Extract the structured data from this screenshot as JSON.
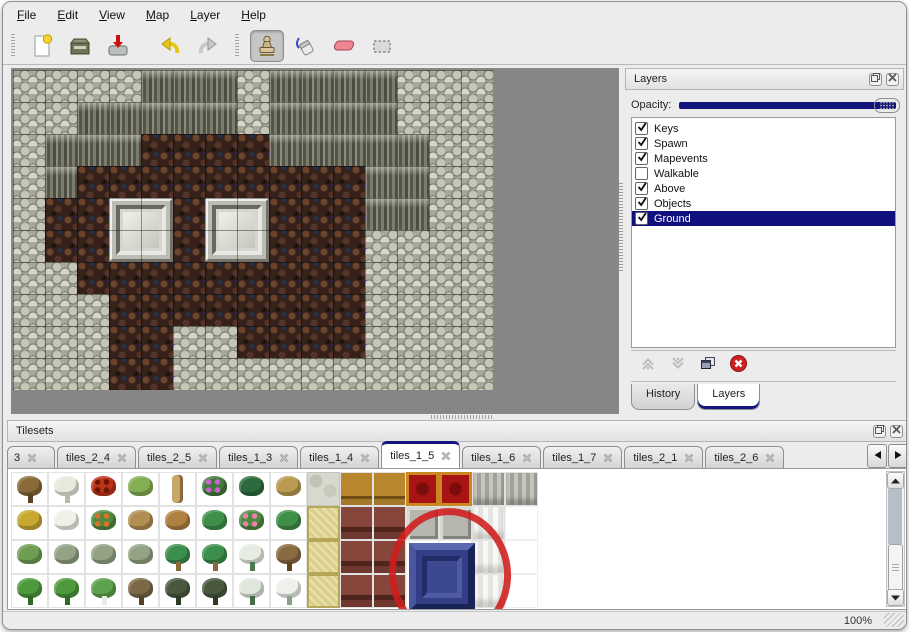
{
  "menu": {
    "items": [
      {
        "label": "File"
      },
      {
        "label": "Edit"
      },
      {
        "label": "View"
      },
      {
        "label": "Map"
      },
      {
        "label": "Layer"
      },
      {
        "label": "Help"
      }
    ]
  },
  "toolbar": {
    "buttons": [
      {
        "name": "new-map",
        "icon": "new",
        "active": false
      },
      {
        "name": "open-map",
        "icon": "open",
        "active": false
      },
      {
        "name": "save-map",
        "icon": "save",
        "active": false
      },
      {
        "name": "undo",
        "icon": "undo",
        "active": false
      },
      {
        "name": "redo",
        "icon": "redo",
        "active": false
      },
      {
        "name": "stamp-tool",
        "icon": "stamp",
        "active": true
      },
      {
        "name": "fill-tool",
        "icon": "fill",
        "active": false
      },
      {
        "name": "eraser-tool",
        "icon": "eraser",
        "active": false
      },
      {
        "name": "select-tool",
        "icon": "select",
        "active": false
      }
    ]
  },
  "map": {
    "legend": {
      "S": "light-scale-rock",
      "C": "dark-cliff-wall",
      "B": "brown-cave-floor"
    },
    "grid": [
      "SSSSCCCSCCCCSSS",
      "SSCCCCCSCCCCSSS",
      "SCCCBBBBCCCCCSS",
      "SCBBBBBBBBBCCSS",
      "SBBBBBBBBBBCCSS",
      "SBBBBBBBBBBSSSS",
      "SSBBBBBBBBBSSSS",
      "SSSBBBBBBBBSSSS",
      "SSSBBSSBBBBSSSS",
      "SSSBBSSSSSSSSSS"
    ],
    "doors": [
      {
        "col": 3,
        "row": 4
      },
      {
        "col": 6,
        "row": 4
      }
    ]
  },
  "layers_panel": {
    "title": "Layers",
    "opacity_label": "Opacity:",
    "opacity_value_percent": 100,
    "layers": [
      {
        "label": "Keys",
        "checked": true,
        "selected": false
      },
      {
        "label": "Spawn",
        "checked": true,
        "selected": false
      },
      {
        "label": "Mapevents",
        "checked": true,
        "selected": false
      },
      {
        "label": "Walkable",
        "checked": false,
        "selected": false
      },
      {
        "label": "Above",
        "checked": true,
        "selected": false
      },
      {
        "label": "Objects",
        "checked": true,
        "selected": false
      },
      {
        "label": "Ground",
        "checked": true,
        "selected": true
      }
    ],
    "tools": [
      {
        "name": "move-layer-up",
        "icon": "chevUp",
        "enabled": false
      },
      {
        "name": "move-layer-down",
        "icon": "chevDown",
        "enabled": false
      },
      {
        "name": "duplicate-layer",
        "icon": "copy",
        "enabled": true
      },
      {
        "name": "delete-layer",
        "icon": "delete",
        "enabled": true
      }
    ],
    "tabs": [
      {
        "label": "History",
        "active": false
      },
      {
        "label": "Layers",
        "active": true
      }
    ]
  },
  "tilesets_panel": {
    "title": "Tilesets",
    "tabs": [
      {
        "label": "3",
        "active": false,
        "partial": true
      },
      {
        "label": "tiles_2_4",
        "active": false
      },
      {
        "label": "tiles_2_5",
        "active": false
      },
      {
        "label": "tiles_1_3",
        "active": false
      },
      {
        "label": "tiles_1_4",
        "active": false
      },
      {
        "label": "tiles_1_5",
        "active": true
      },
      {
        "label": "tiles_1_6",
        "active": false
      },
      {
        "label": "tiles_1_7",
        "active": false
      },
      {
        "label": "tiles_2_1",
        "active": false
      },
      {
        "label": "tiles_2_6",
        "active": false
      }
    ],
    "nature_grid": [
      [
        "tree-bare",
        "tree-white",
        "flower-red",
        "stump",
        "trunk-tall",
        "bush-purple",
        "palm-dark",
        "plant-dry"
      ],
      [
        "hay-mound",
        "snow-mound",
        "flowers-orange",
        "grass-dry",
        "leaves",
        "lily-pad",
        "flowers-pink",
        "lily-pad"
      ],
      [
        "sprouts",
        "bush-sage",
        "bush-sage",
        "bush-sage",
        "palm-tree",
        "palm-tree",
        "pine-snow",
        "palm-trunk"
      ],
      [
        "tree-cone",
        "tree-cone",
        "tree-cone-snow",
        "tree-twisted",
        "tree-dark",
        "tree-dark",
        "pine-snow-tall",
        "tree-snowy"
      ]
    ],
    "furniture_grid": [
      [
        "stone-floor",
        "wood-shelf",
        "wood-shelf",
        "carpet-red",
        "carpet-red",
        "curtain-gray",
        "curtain-gray"
      ],
      [
        "mat-tan",
        "table-red",
        "table-red",
        "stone-blocks",
        "stone-blocks",
        "curtain-white",
        "blank"
      ],
      [
        "mat-tan",
        "table-red",
        "table-red",
        "blank",
        "blank",
        "curtain-white",
        "blank"
      ],
      [
        "mat-tan",
        "table-red",
        "table-red",
        "blank",
        "blank",
        "curtain-white",
        "blank"
      ]
    ],
    "highlighted_tile": "blue-beveled-tile"
  },
  "status": {
    "zoom_level": "100%"
  },
  "colors": {
    "accent_navy": "#14147e",
    "selection_bg": "#10107e",
    "window_bg": "#ececec",
    "canvas_gray": "#868686",
    "annotation_red": "#d01c1c"
  }
}
